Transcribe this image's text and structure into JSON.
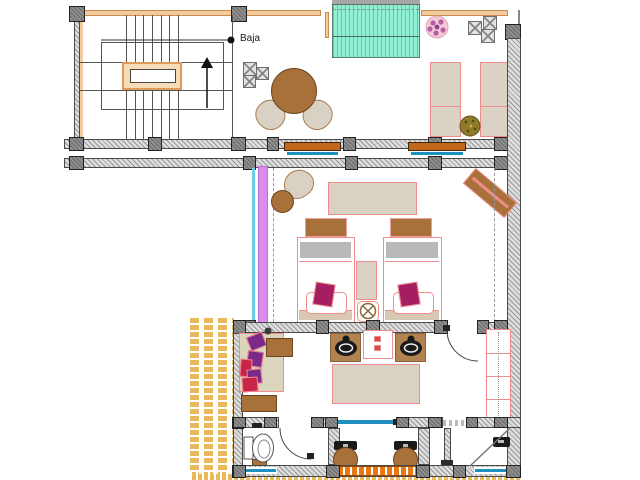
{
  "meta": {
    "drawing_type": "architectural floor plan, upper level (CAD style)",
    "canvas": {
      "width": 640,
      "height": 480
    }
  },
  "labels": {
    "stairs_direction": "Baja"
  },
  "palette": {
    "wheat": "#f2cb9e",
    "accent_wood": "#a9713a",
    "accent_wood_dark": "#6b4620",
    "pool_teal": "#8ff0d4",
    "glass_blue": "#1f8fbf",
    "glass_cyan": "#6ccde8",
    "window_violet": "#dd8bef",
    "furniture_outline_pink": "#f08c8c",
    "bed_band_grey": "#b9b9b9",
    "cushion_magenta": "#a51e62",
    "cushion_purple": "#7b2a8b",
    "cushion_red": "#c8234a",
    "upholstery_beige": "#d9d2c4",
    "plant_pink": "#f4c9d8",
    "plant_green": "#8f7b2a",
    "hatch_gold": "#e9b95b",
    "grate_orange": "#e87812"
  },
  "inventory": {
    "stair_block": [
      "staircase",
      "landing",
      "direction-arrow"
    ],
    "terrace": [
      "round-table",
      "chairs",
      "plunge-pool",
      "floor-cushions",
      "potted-plant-pink",
      "sun-loungers",
      "potted-plant-green"
    ],
    "bedroom": [
      "twin-bed-left",
      "twin-bed-right",
      "nightstand",
      "ceiling-light",
      "armchair",
      "side-table",
      "bench",
      "rug",
      "glass-wall"
    ],
    "bathroom": [
      "sofa",
      "coffee-table",
      "double-vanity",
      "rug",
      "wardrobe",
      "toilet",
      "shower-stools",
      "shower-fixtures"
    ]
  }
}
